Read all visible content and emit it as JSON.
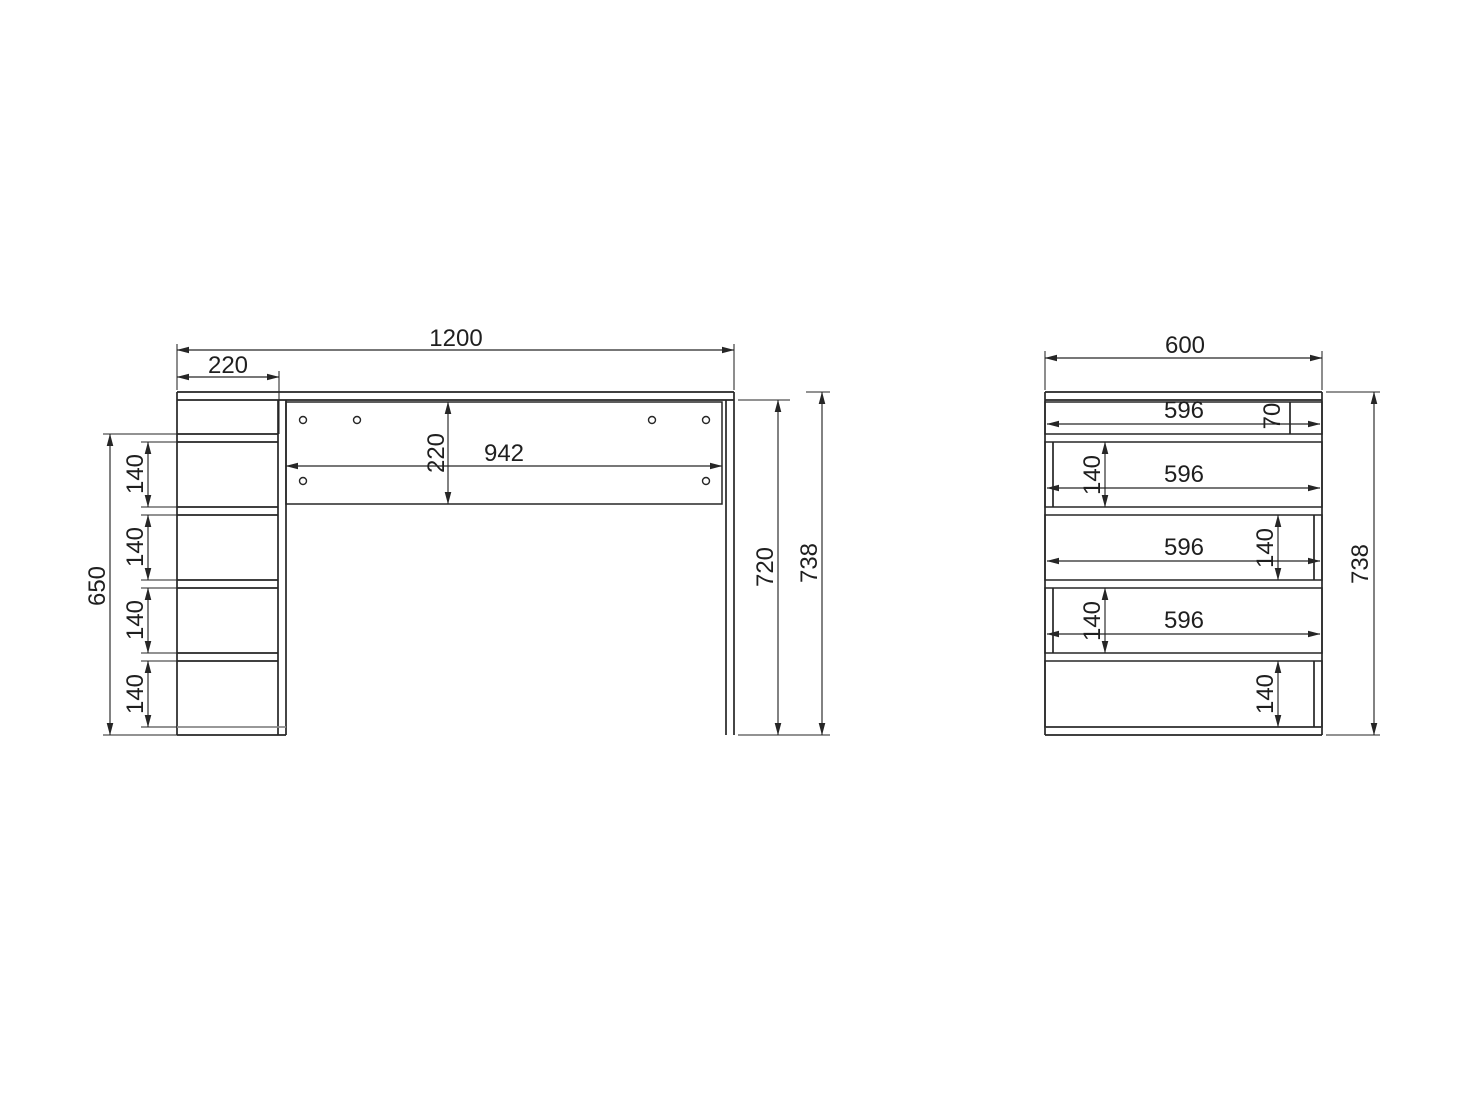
{
  "drawing": {
    "type": "furniture dimension drawing",
    "unit": "mm",
    "front_view": {
      "name": "desk front view",
      "dim_total_width": "1200",
      "dim_column_width": "220",
      "dim_apron_length": "942",
      "dim_apron_height": "220",
      "dim_column_height": "650",
      "dim_shelf_spacing": [
        "140",
        "140",
        "140",
        "140"
      ],
      "dim_leg_height": "720",
      "dim_total_height": "738"
    },
    "side_view": {
      "name": "desk side view",
      "dim_total_depth": "600",
      "dim_shelf_depth": [
        "596",
        "596",
        "596",
        "596"
      ],
      "dim_top_rail_depth": "70",
      "dim_shelf_spacing": [
        "140",
        "140",
        "140",
        "140"
      ],
      "dim_total_height": "738"
    },
    "colors": {
      "line": "#262626",
      "background": "#ffffff",
      "label": "#1f1f1f"
    }
  }
}
